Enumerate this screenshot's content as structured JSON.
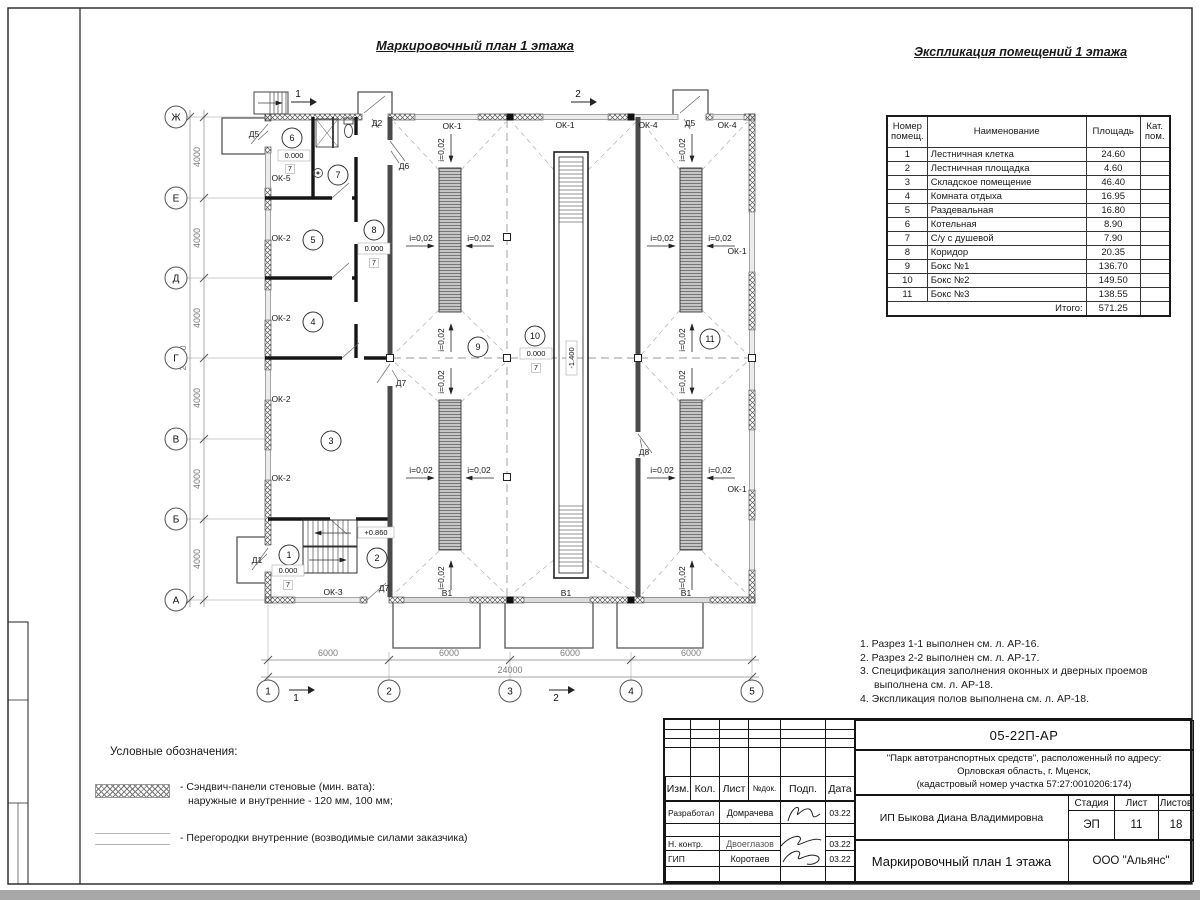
{
  "titles": {
    "plan": "Маркировочный план 1 этажа",
    "table": "Экспликация помещений 1 этажа"
  },
  "table": {
    "col_num": "Номер\nпомещ.",
    "col_name": "Наименование",
    "col_area": "Площадь",
    "col_cat": "Кат.\nпом.",
    "rows": [
      {
        "n": "1",
        "name": "Лестничная клетка",
        "area": "24.60"
      },
      {
        "n": "2",
        "name": "Лестничная площадка",
        "area": "4.60"
      },
      {
        "n": "3",
        "name": "Складское помещение",
        "area": "46.40"
      },
      {
        "n": "4",
        "name": "Комната отдыха",
        "area": "16.95"
      },
      {
        "n": "5",
        "name": "Раздевальная",
        "area": "16.80"
      },
      {
        "n": "6",
        "name": "Котельная",
        "area": "8.90"
      },
      {
        "n": "7",
        "name": "С/у с душевой",
        "area": "7.90"
      },
      {
        "n": "8",
        "name": "Коридор",
        "area": "20.35"
      },
      {
        "n": "9",
        "name": "Бокс №1",
        "area": "136.70"
      },
      {
        "n": "10",
        "name": "Бокс №2",
        "area": "149.50"
      },
      {
        "n": "11",
        "name": "Бокс №3",
        "area": "138.55"
      }
    ],
    "total_label": "Итого:",
    "total": "571.25"
  },
  "notes": [
    "1. Разрез 1-1 выполнен см. л. АР-16.",
    "2. Разрез 2-2 выполнен см. л. АР-17.",
    "3. Спецификация заполнения оконных и дверных проемов выполнена см. л. АР-18.",
    "4. Экспликация полов выполнена см. л. АР-18."
  ],
  "legend": {
    "title": "Условные обозначения:",
    "item1_line1": "- Сэндвич-панели стеновые (мин. вата):",
    "item1_line2": "наружные и внутренние - 120 мм, 100 мм;",
    "item2": "- Перегородки внутренние (возводимые силами заказчика)"
  },
  "titleblock": {
    "doc": "05-22П-АР",
    "project1": "\"Парк автотранспортных средств\",  расположенный по адресу:",
    "project2": "Орловская область, г. Мценск,",
    "project3": "(кадастровый номер участка 57:27:0010206:174)",
    "client": "ИП Быкова Диана Владимировна",
    "drawing": "Маркировочный план 1 этажа",
    "org": "ООО \"Альянс\"",
    "stage_h": "Стадия",
    "list_h": "Лист",
    "lists_h": "Листов",
    "stage": "ЭП",
    "list": "11",
    "lists": "18",
    "cols": [
      "Изм.",
      "Кол.",
      "Лист",
      "№док.",
      "Подп.",
      "Дата"
    ],
    "r1_role": "Разработал",
    "r1_name": "Домрачева",
    "r1_date": "03.22",
    "r2_role": "Н. контр.",
    "r2_name": "Двоеглазов",
    "r2_date": "03.22",
    "r3_role": "ГИП",
    "r3_name": "Коротаев",
    "r3_date": "03.22"
  },
  "plan": {
    "axis_rows": [
      "Ж",
      "Е",
      "Д",
      "Г",
      "В",
      "Б",
      "А"
    ],
    "axis_cols": [
      "1",
      "2",
      "3",
      "4",
      "5"
    ],
    "dim4000": "4000",
    "dim24000": "24000",
    "dim6000": "6000",
    "slope": "i=0,02",
    "rooms": [
      "1",
      "2",
      "3",
      "4",
      "5",
      "6",
      "7",
      "8",
      "9",
      "10",
      "11"
    ],
    "marks": {
      "ok1": "ОК-1",
      "ok2": "ОК-2",
      "ok3": "ОК-3",
      "ok4": "ОК-4",
      "ok5": "ОК-5",
      "d1": "Д1",
      "d2": "Д2",
      "d5": "Д5",
      "d6": "Д6",
      "d7": "Д7",
      "d8": "Д8",
      "gate": "В1"
    },
    "levels": {
      "zero": "0.000",
      "up": "+0.860",
      "pit": "-1.400"
    },
    "floor_tag": "7",
    "sections": {
      "s1": "1",
      "s2": "2"
    }
  }
}
